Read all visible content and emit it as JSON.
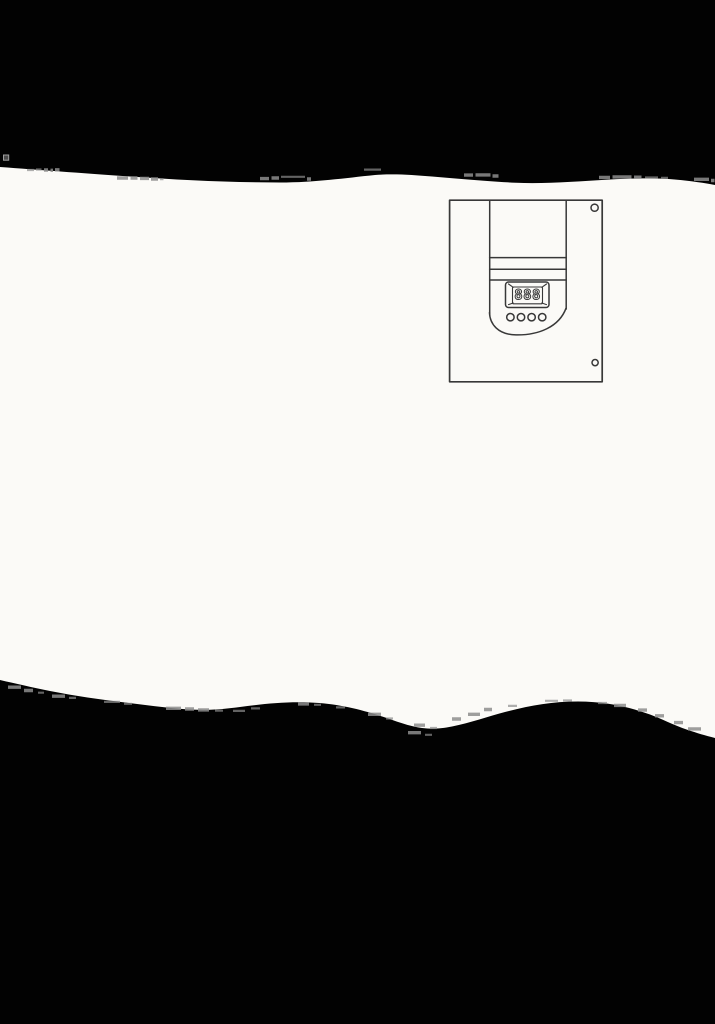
{
  "page": {
    "background_color": "#020202",
    "paper_color": "#fbfaf7"
  },
  "figure": {
    "line_color": "#383838",
    "display": {
      "value": "888"
    },
    "keypad_button_count": 4,
    "screw_hole_count": 2
  }
}
